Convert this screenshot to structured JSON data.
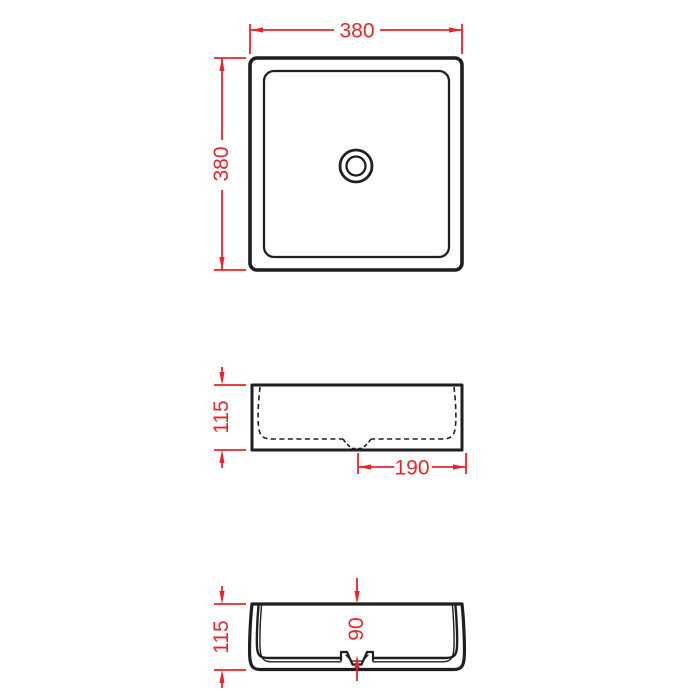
{
  "colors": {
    "dimension_red": "#e8252b",
    "drawing_black": "#1f1f1f",
    "background": "#ffffff"
  },
  "views": {
    "top": {
      "label": "top-view",
      "width_dim": "380",
      "height_dim": "380"
    },
    "front": {
      "label": "front-view",
      "height_dim": "115",
      "drain_to_edge_dim": "190"
    },
    "section": {
      "label": "side-section-view",
      "height_dim": "115",
      "inner_depth_dim": "90"
    }
  }
}
